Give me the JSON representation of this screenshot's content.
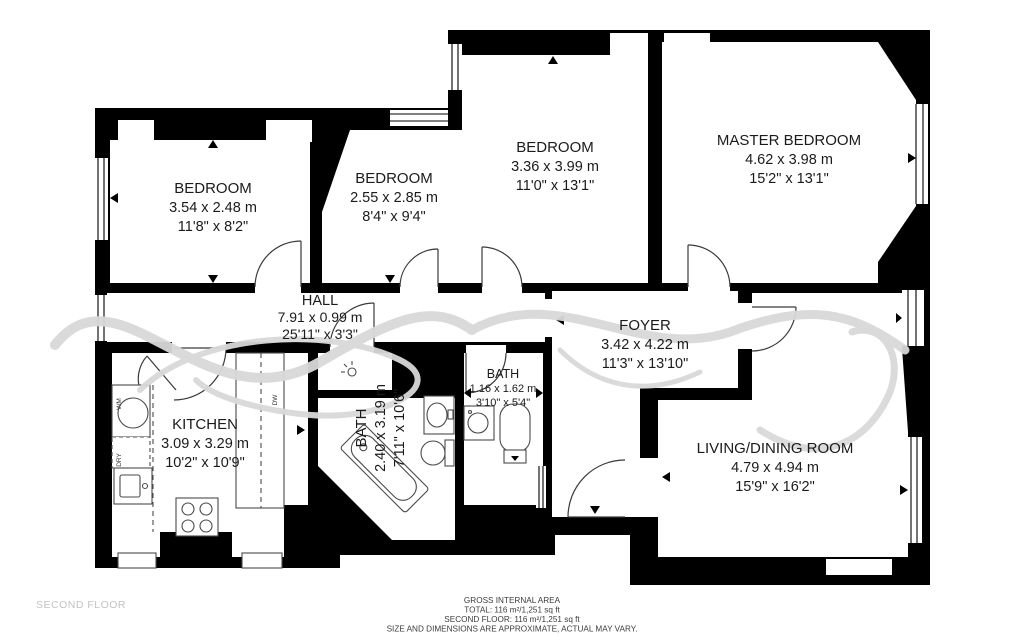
{
  "floor_label": "SECOND FLOOR",
  "footer": {
    "line1": "GROSS INTERNAL AREA",
    "line2": "TOTAL: 116 m²/1,251 sq ft",
    "line3": "SECOND FLOOR: 116 m²/1,251 sq ft",
    "line4": "SIZE AND DIMENSIONS ARE APPROXIMATE, ACTUAL MAY VARY."
  },
  "rooms": {
    "bedroom1": {
      "name": "BEDROOM",
      "metric": "3.54 x 2.48 m",
      "imperial": "11'8\" x 8'2\""
    },
    "bedroom2": {
      "name": "BEDROOM",
      "metric": "2.55 x 2.85 m",
      "imperial": "8'4\" x 9'4\""
    },
    "bedroom3": {
      "name": "BEDROOM",
      "metric": "3.36 x 3.99 m",
      "imperial": "11'0\" x 13'1\""
    },
    "master": {
      "name": "MASTER BEDROOM",
      "metric": "4.62 x 3.98 m",
      "imperial": "15'2\" x 13'1\""
    },
    "hall": {
      "name": "HALL",
      "metric": "7.91 x 0.99 m",
      "imperial": "25'11\" x 3'3\""
    },
    "foyer": {
      "name": "FOYER",
      "metric": "3.42 x 4.22 m",
      "imperial": "11'3\" x 13'10\""
    },
    "kitchen": {
      "name": "KITCHEN",
      "metric": "3.09 x 3.29 m",
      "imperial": "10'2\" x 10'9\""
    },
    "bath_large": {
      "name": "BATH",
      "metric": "2.40 x 3.19 m",
      "imperial": "7'11\" x 10'6\""
    },
    "bath_small": {
      "name": "BATH",
      "metric": "1.16 x 1.62 m",
      "imperial": "3'10\" x 5'4\""
    },
    "living": {
      "name": "LIVING/DINING ROOM",
      "metric": "4.79 x 4.94 m",
      "imperial": "15'9\" x 16'2\""
    }
  },
  "appliances": {
    "washing_machine": "WM",
    "dryer": "DRY",
    "dishwasher": "DW"
  },
  "colors": {
    "wall": "#000000",
    "floor": "#ffffff",
    "watermark": "#d9d9d9",
    "floor_label": "#c3c3c3"
  }
}
